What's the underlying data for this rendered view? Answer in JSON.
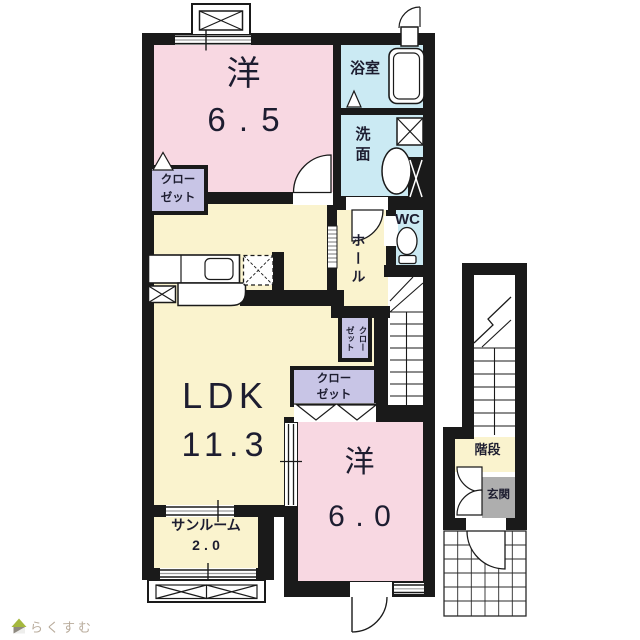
{
  "rooms": {
    "bedroom1": {
      "name": "洋",
      "size": "6.5"
    },
    "bathroom": {
      "name": "浴室"
    },
    "washroom": {
      "name": "洗面"
    },
    "toilet": {
      "name": "WC"
    },
    "hall": {
      "name": "ホール"
    },
    "ldk": {
      "name": "LDK",
      "size": "11.3"
    },
    "bedroom2": {
      "name": "洋",
      "size": "6.0"
    },
    "sunroom": {
      "name": "サンルーム",
      "size": "2.0"
    },
    "stairs": {
      "name": "階段"
    },
    "entrance": {
      "name": "玄関"
    },
    "closet_bedroom1": {
      "line1": "クロー",
      "line2": "ゼット"
    },
    "closet_hall": {
      "col_right": "クロー",
      "col_left": "ゼット"
    },
    "closet_bedroom2": {
      "line1": "クロー",
      "line2": "ゼット"
    }
  },
  "watermark": {
    "text": "らくすむ"
  },
  "colors": {
    "wall": "#1a1a1a",
    "room-pink": "#f8d8e2",
    "room-yellow": "#faf3ce",
    "room-cyan": "#cbeaf3",
    "closet-lavender": "#c8c5e6",
    "entry-gray": "#aeaeae",
    "label": "#1d1d30",
    "watermark-text": "#b9ac9c",
    "logo-green": "#a5b83e",
    "logo-gray": "#8f8a80"
  }
}
